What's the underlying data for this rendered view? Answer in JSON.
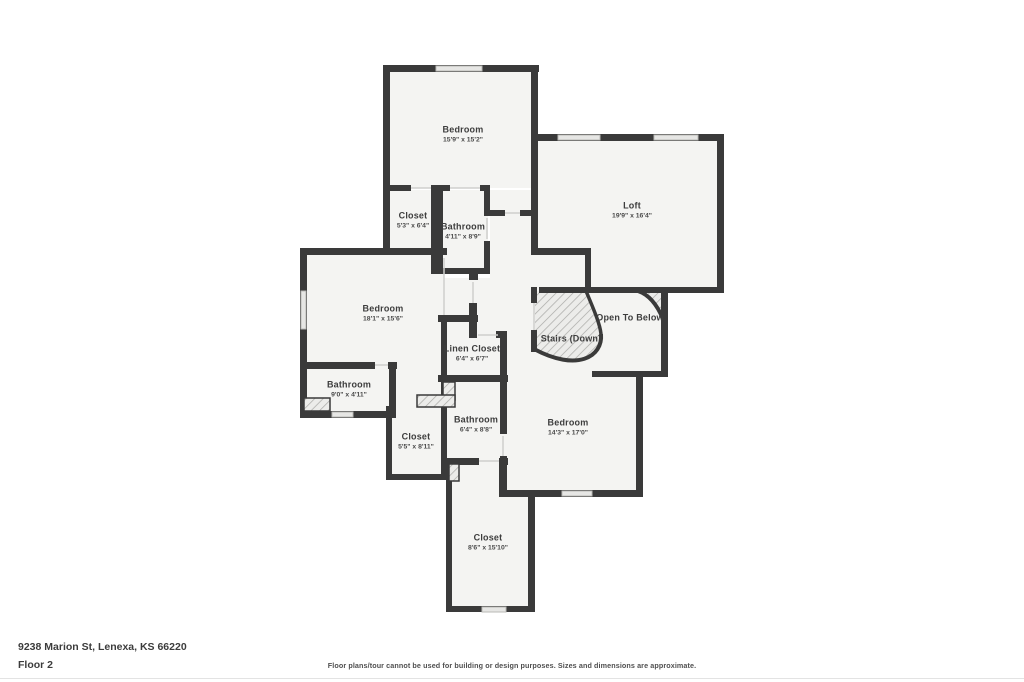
{
  "floorplan": {
    "rooms": [
      {
        "id": "bedroom-top",
        "name": "Bedroom",
        "dims": "15'9\" x 15'2\"",
        "cx": 463,
        "cy": 135
      },
      {
        "id": "loft",
        "name": "Loft",
        "dims": "19'9\" x 16'4\"",
        "cx": 632,
        "cy": 211
      },
      {
        "id": "closet-upper",
        "name": "Closet",
        "dims": "5'3\" x 6'4\"",
        "cx": 413,
        "cy": 221
      },
      {
        "id": "bathroom-upper",
        "name": "Bathroom",
        "dims": "4'11\" x 8'9\"",
        "cx": 463,
        "cy": 232
      },
      {
        "id": "bedroom-left",
        "name": "Bedroom",
        "dims": "18'1\" x 15'6\"",
        "cx": 383,
        "cy": 314
      },
      {
        "id": "linen-closet",
        "name": "Linen Closet",
        "dims": "6'4\" x 6'7\"",
        "cx": 472,
        "cy": 354
      },
      {
        "id": "stairs-down",
        "name": "Stairs (Down)",
        "dims": "",
        "cx": 571,
        "cy": 339
      },
      {
        "id": "open-to-below",
        "name": "Open To Below",
        "dims": "",
        "cx": 630,
        "cy": 318
      },
      {
        "id": "bathroom-left",
        "name": "Bathroom",
        "dims": "9'0\" x 4'11\"",
        "cx": 349,
        "cy": 390
      },
      {
        "id": "bathroom-mid",
        "name": "Bathroom",
        "dims": "6'4\" x 8'8\"",
        "cx": 476,
        "cy": 425
      },
      {
        "id": "closet-mid",
        "name": "Closet",
        "dims": "5'5\" x 8'11\"",
        "cx": 416,
        "cy": 442
      },
      {
        "id": "bedroom-right",
        "name": "Bedroom",
        "dims": "14'3\" x 17'0\"",
        "cx": 568,
        "cy": 428
      },
      {
        "id": "closet-bottom",
        "name": "Closet",
        "dims": "8'6\" x 15'10\"",
        "cx": 488,
        "cy": 543
      }
    ],
    "footer": {
      "address": "9238 Marion St, Lenexa, KS 66220",
      "floor": "Floor 2",
      "disclaimer": "Floor plans/tour cannot be used for building or design purposes. Sizes and dimensions are approximate."
    },
    "colors": {
      "wall": "#3a3a3a",
      "room_fill": "#f4f4f2",
      "window_fill": "#e6e6e4",
      "door_marker": "#cfcfcd",
      "hatch_line": "#a8a8a5"
    }
  }
}
